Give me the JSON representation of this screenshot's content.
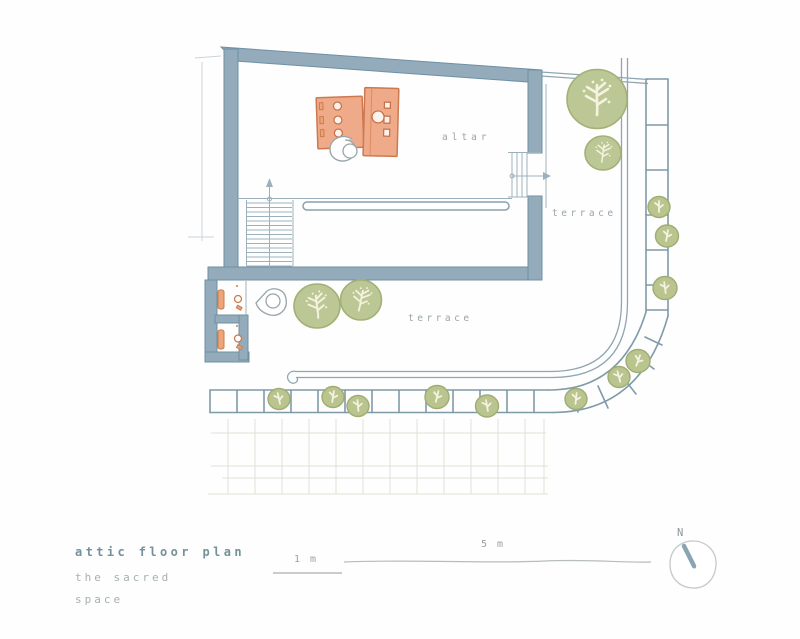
{
  "plan": {
    "labels": {
      "altar": "altar",
      "terrace_upper": "terrace",
      "terrace_lower": "terrace"
    }
  },
  "title_block": {
    "title": "attic floor plan",
    "subtitle_line1": "the sacred",
    "subtitle_line2": "space"
  },
  "scale_bar": {
    "small_label": "1 m",
    "large_label": "5 m"
  },
  "compass": {
    "north_label": "N"
  },
  "colors": {
    "wall": "#93abbb",
    "wall_edge": "#6f90a3",
    "altar_fill": "#efab89",
    "altar_edge": "#cc7950",
    "tree_fill": "#bbc794",
    "tree_edge": "#a3b076",
    "branch": "#f5f2df",
    "plan_line": "#8fa6b2",
    "label_gray": "#9aa4a7",
    "title_teal": "#74909a",
    "ghost_line": "#dddcd2"
  }
}
